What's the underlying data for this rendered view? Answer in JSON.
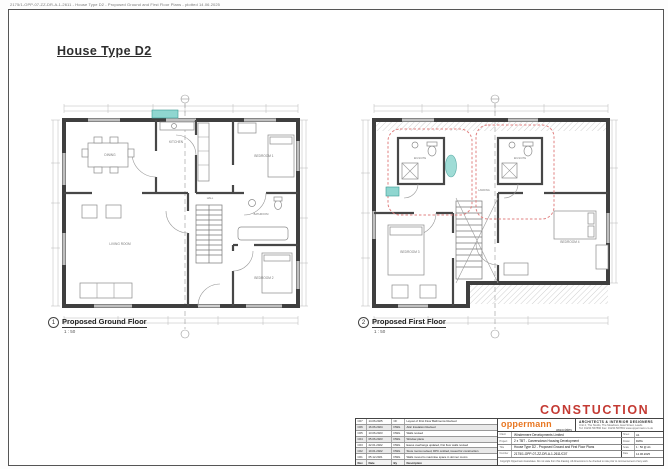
{
  "colors": {
    "accent_orange": "#e87722",
    "stamp_red": "#c43a33",
    "highlight_teal": "#8fd6d0",
    "revision_cloud_red": "#e08080"
  },
  "page": {
    "print_header": "2175/1-OPP-07-ZZ-DR-A-1-2611 - House Type D2 - Proposed Ground and First Floor Plans - plotted 14.06.2025",
    "title": "House Type D2"
  },
  "stamp": {
    "text": "CONSTUCTION"
  },
  "plans": [
    {
      "number": "1",
      "caption": "Proposed Ground Floor",
      "scale": "1 : 50",
      "rooms": {
        "dining": "DINING",
        "kitchen": "KITCHEN",
        "bedroom1": "BEDROOM 1",
        "bathroom": "BATHROOM",
        "bedroom2": "BEDROOM 2",
        "living": "LIVING ROOM",
        "hall": "HALL"
      }
    },
    {
      "number": "2",
      "caption": "Proposed First Floor",
      "scale": "1 : 50",
      "rooms": {
        "bedroom3": "BEDROOM 3",
        "bedroom4": "BEDROOM 4",
        "ensuite1": "EN-SUITE",
        "ensuite2": "EN-SUITE",
        "landing": "LANDING"
      }
    }
  ],
  "revisions": {
    "headers": {
      "rev": "Rev",
      "date": "Date",
      "by": "By",
      "desc": "Description"
    },
    "rows": [
      {
        "rev": "C07",
        "date": "14.06.2025",
        "by": "CF",
        "desc": "Layout of First Floor Bathrooms Revised"
      },
      {
        "rev": "C06",
        "date": "16.06.2024",
        "by": "DWG",
        "desc": "Attic Insulation Revised"
      },
      {
        "rev": "C05",
        "date": "13.06.2023",
        "by": "DWG",
        "desc": "Walls revised"
      },
      {
        "rev": "C04",
        "date": "05.06.2023",
        "by": "DWG",
        "desc": "Window plans"
      },
      {
        "rev": "C03",
        "date": "22.01.2022",
        "by": "DWG",
        "desc": "Eaves overhangs updated, first floor walls revised"
      },
      {
        "rev": "C02",
        "date": "10.01.2022",
        "by": "DWG",
        "desc": "Store rooms revised, DPC omitted, issued for construction"
      },
      {
        "rev": "C01",
        "date": "05.12.2021",
        "by": "DWG",
        "desc": "Walls moved to maximise space in dormer rooms"
      }
    ]
  },
  "title_block": {
    "logo": "oppermann",
    "logo_sub": "associates",
    "tagline": "ARCHITECTS  &  INTERIOR  DESIGNERS",
    "address": "Unit 4, The Studio, The Meadows, East Street, Leeds",
    "contact": "Tel: 01234 567890  Fax: 01234 567891  www.oppermann.co.uk",
    "fields": {
      "client": {
        "label": "Client",
        "value": "Windermere Developments Limited",
        "side_label": "Sheet",
        "side_value": "A1"
      },
      "project": {
        "label": "Project",
        "value": "2 x TBT - Carversdown Housing Development",
        "side_label": "Drawn",
        "side_value": "DWG"
      },
      "title": {
        "label": "Title",
        "value": "House Type D2 - Proposed Ground and First Floor Plans",
        "side_label": "Scale",
        "side_value": "1 : 50 @ A1"
      },
      "number": {
        "label": "Number",
        "value": "2175/1-OPP-07-ZZ-DR-A-1-2611/C07",
        "side_label": "Date",
        "side_value": "14.06.2025"
      }
    },
    "disclaimer": "Copyright Oppermann Associates. Do not scale from this drawing. All dimensions to be checked on site prior to commencement of any work."
  }
}
